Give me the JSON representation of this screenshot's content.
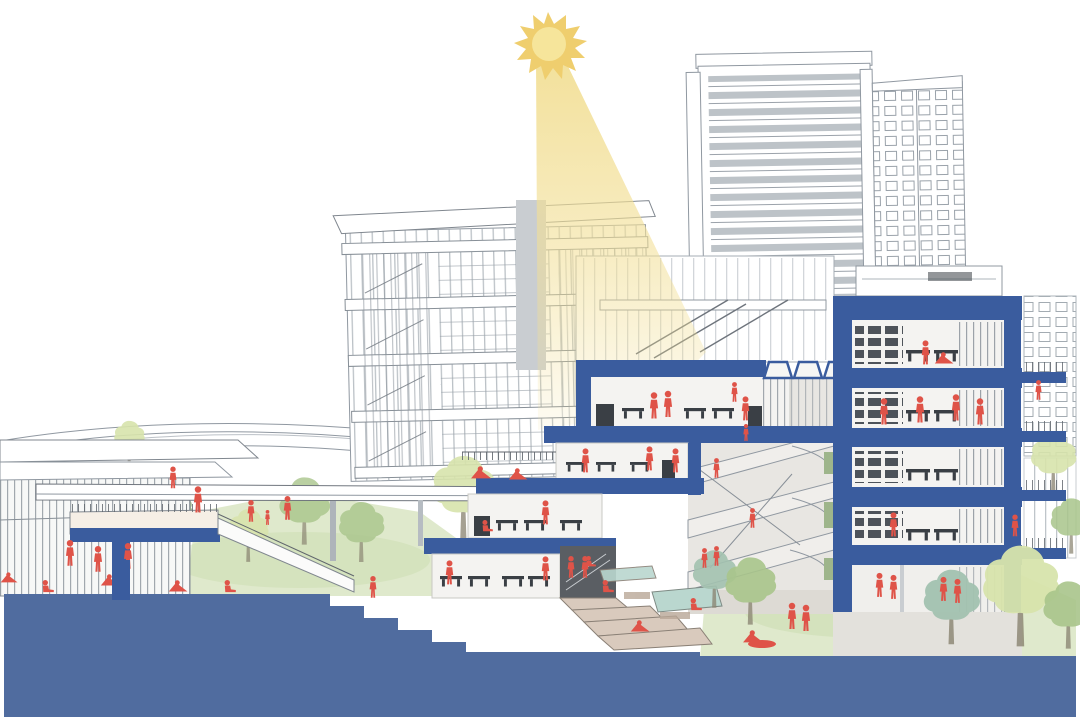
{
  "scene": {
    "title": "Sectional perspective architectural rendering",
    "description": "Cut-away section through a terraced mixed-use building complex: blue section-cut slabs and ground mass, white line-art background towers, a sun casting a yellow light beam, watercolor trees and lawns, and red human figures occupying floors, terraces, walkways and gardens.",
    "type": "architectural-section-diagram",
    "visible_text": []
  },
  "palette": {
    "section-blue": "#3A5C9E",
    "section-blue-dark": "#32528F",
    "ground-blue": "#506C9F",
    "sun-gold": "#EFCE6E",
    "sun-core": "#F6E59B",
    "beam-yellow": "#F2DF96",
    "line-gray": "#9098A1",
    "line-light": "#BCC2C8",
    "line-dark": "#60666D",
    "window-gray": "#A9B0B7",
    "glass-gray": "#C9CDD2",
    "furniture-dark": "#3A3F45",
    "figure-red": "#DF5348",
    "interior-white": "#F4F3F1",
    "atrium-gray": "#E8E6E2",
    "wall-shadow": "#E3E1DC",
    "core-gray": "#C9CDD1",
    "grass-light": "#DFE9CC",
    "grass-mid": "#CADCAD",
    "tree-light": "#D8E4AC",
    "tree-mid": "#A9C58B",
    "tree-dark": "#90B277",
    "tree-teal": "#A3C2B0",
    "terrace-tan": "#D9CABD",
    "terrace-dark": "#B9A797",
    "pool-teal": "#BAD7CF",
    "accent-green": "#9EB58B"
  },
  "elements": [
    {
      "name": "sun",
      "label": "Sun"
    },
    {
      "name": "light-beam",
      "label": "Sunlight beam"
    },
    {
      "name": "background-tower",
      "label": "High-rise tower (background)"
    },
    {
      "name": "mid-rise-building",
      "label": "Mid-rise slab building (background)"
    },
    {
      "name": "terraced-section-building",
      "label": "Terraced sectional building (center)"
    },
    {
      "name": "right-section-building",
      "label": "Five-storey sectional building (right)"
    },
    {
      "name": "atrium",
      "label": "Central atrium with walkways and ramps"
    },
    {
      "name": "glass-pavilion",
      "label": "Glass pavilion (left)"
    },
    {
      "name": "elevated-walkway",
      "label": "Elevated walkway / footbridge"
    },
    {
      "name": "ground-mass",
      "label": "Blue site-section ground mass"
    },
    {
      "name": "landscape",
      "label": "Lawns, terraced steps, pool and trees"
    },
    {
      "name": "figures",
      "label": "Red human figures"
    }
  ],
  "figures": {
    "count": 40,
    "color_key": "figure-red"
  }
}
